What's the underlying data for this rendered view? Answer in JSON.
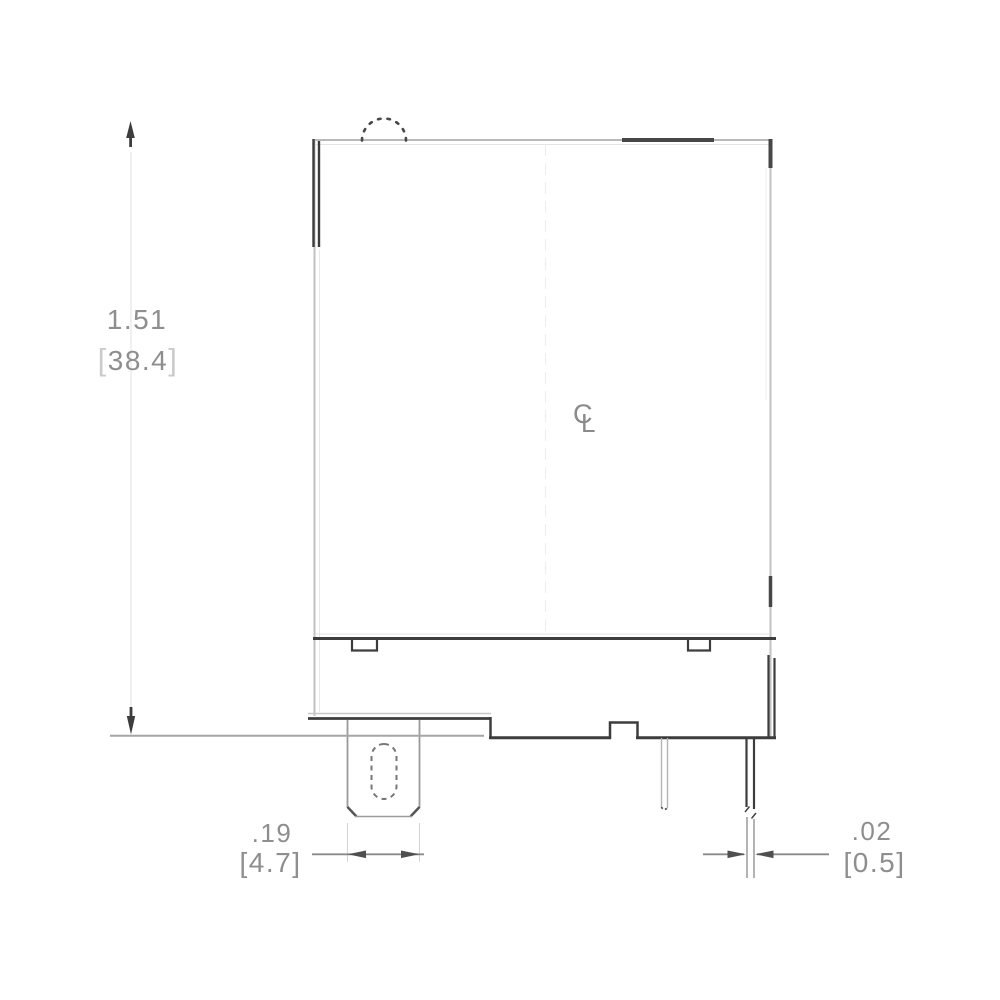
{
  "drawing": {
    "height_dimension": {
      "inches": "1.51",
      "mm_value": "38.4",
      "bracket_open": "[",
      "bracket_close": "]"
    },
    "tab_width_dimension": {
      "inches": ".19",
      "mm": "[4.7]"
    },
    "pin_thickness_dimension": {
      "inches": ".02",
      "mm": "[0.5]"
    },
    "centerline_symbol": {
      "c": "C",
      "l": "L"
    },
    "colors": {
      "line_dark": "#3d3d3d",
      "line_medium": "#8a8a8a",
      "line_light": "#c4c4c4",
      "text_gray": "#8e8e8e",
      "background": "#ffffff"
    }
  }
}
